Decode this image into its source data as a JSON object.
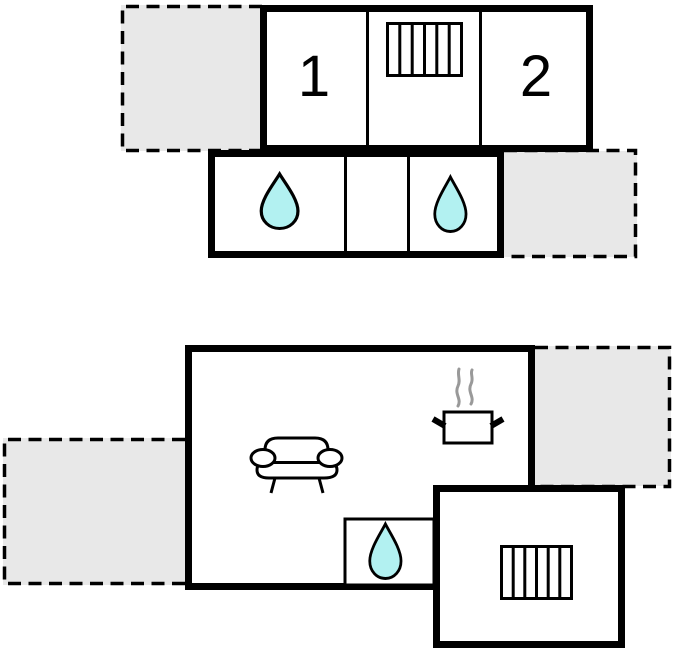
{
  "colors": {
    "wall": "#000000",
    "room_fill": "#ffffff",
    "terrace_fill": "#e8e8e8",
    "water_drop_fill": "#b2f1f1",
    "steam": "#999999"
  },
  "rooms": {
    "bedroom_1_label": "1",
    "bedroom_2_label": "2"
  },
  "icons": {
    "radiator": "radiator-icon",
    "water_drop": "water-drop-icon",
    "sofa": "sofa-icon",
    "cooking_pot": "cooking-pot-icon",
    "steam": "steam-icon"
  }
}
